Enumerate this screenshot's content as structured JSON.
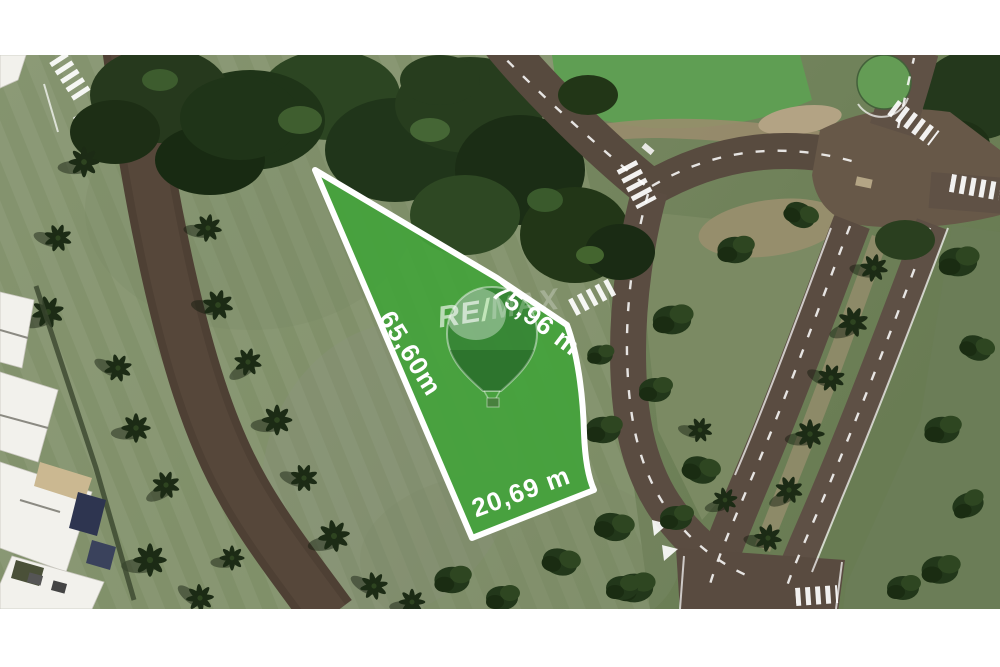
{
  "photo": {
    "kind": "satellite-aerial-photo",
    "margin_color": "#ffffff"
  },
  "lot_overlay": {
    "fill_color": "#44a23b",
    "border_color": "#ffffff",
    "measurement_left": "65,60m",
    "measurement_top": "75,96 m",
    "measurement_bottom": "20,69 m"
  },
  "watermark": {
    "brand": "RE/MAX",
    "part_re": "RE",
    "part_slash": "/",
    "part_max": "MAX",
    "balloon_icon": "hot-air-balloon-icon"
  }
}
